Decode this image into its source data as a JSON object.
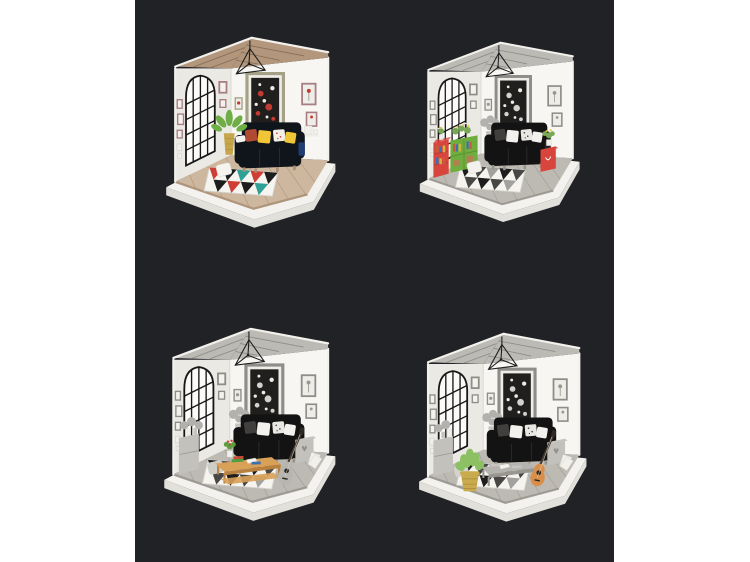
{
  "page": {
    "margin_color": "#ffffff",
    "backdrop_color": "#212226",
    "layout": "2x2 product photo collage of miniature dollhouse dioramas"
  },
  "dioramas": [
    {
      "name": "diorama-colorful-living-room",
      "alt": "Miniature dollhouse living room with dark navy sofa, yellow cushions, red and teal triangle rug, palm plant in gold pot, arched black window and tan wooden slat roof",
      "colors": {
        "roof": "#b2977d",
        "roof_slat": "#8a6f58",
        "floor": "#cdb79e",
        "floor_line": "#a98e72",
        "rug_a": "#cf3e35",
        "rug_b": "#2fa096",
        "rug_c": "#1d1d1d",
        "sofa": "#10141b",
        "sofa_trim": "#1e3d72",
        "pillow_a": "#f0c637",
        "pillow_b": "#b14a33",
        "pillow_c": "#f4efe6",
        "cushion": "#f6f4ef",
        "plant": "#6fae46",
        "pot": "#c7a64b",
        "art_frame": "#a5a186",
        "art_accent": "#c23b32",
        "wall_frame": "#a87e82"
      }
    },
    {
      "name": "diorama-gray-room-red-green-shelves",
      "alt": "Gray miniature living room with black sofa, black and white triangle rug, red bookcase, green bookshelf with plants and a red side table with yellow flowers",
      "colors": {
        "roof": "#bcbab5",
        "roof_slat": "#908e89",
        "floor": "#bdbab3",
        "floor_line": "#97948d",
        "rug_a": "#1d1d1d",
        "rug_b": "#a3a19d",
        "rug_c": "#484745",
        "sofa": "#131313",
        "sofa_trim": "#262626",
        "pillow_a": "#f3f1ed",
        "pillow_b": "#413f3d",
        "pillow_c": "#e9e7e3",
        "cushion": "#f3f1ec",
        "plant": "#7aa757",
        "flower": "#e4c43e",
        "cabinet": "#d8453c",
        "shelf": "#6fae3e",
        "side_table": "#d8453c",
        "book_a": "#c95a3a",
        "book_b": "#3e6fae",
        "book_c": "#d8b13e",
        "box": "#b08050",
        "art_frame": "#8f8d89",
        "art_accent": "#d3d1cd",
        "wall_frame": "#8f8d89"
      }
    },
    {
      "name": "diorama-gray-room-coffee-table",
      "alt": "Gray miniature living room with black sofa, tan wooden coffee table with colorful books and red flowers in a white pot, gray guitar and black and white triangle rug",
      "colors": {
        "roof": "#bcbab5",
        "roof_slat": "#908e89",
        "floor": "#bdbab3",
        "floor_line": "#97948d",
        "rug_a": "#1d1d1d",
        "rug_b": "#a3a19d",
        "rug_c": "#484745",
        "sofa": "#131313",
        "sofa_trim": "#262626",
        "pillow_a": "#f3f1ed",
        "pillow_b": "#413f3d",
        "pillow_c": "#e9e7e3",
        "cushion": "#cfcdc8",
        "plant": "#5d9e3c",
        "flower": "#cc3a30",
        "table": "#d9a058",
        "table_dark": "#b9813f",
        "guitar": "#b7b5b0",
        "book_a": "#4f9e3f",
        "book_b": "#c94a38",
        "book_c": "#3e6fae",
        "art_frame": "#8f8d89",
        "art_accent": "#d3d1cd",
        "wall_frame": "#8f8d89"
      }
    },
    {
      "name": "diorama-gray-room-basket-plant-guitar",
      "alt": "Gray miniature living room with black sofa, green potted plant in a yellow woven basket, orange acoustic guitar, gray coffee table and black and white triangle rug",
      "colors": {
        "roof": "#bcbab5",
        "roof_slat": "#908e89",
        "floor": "#bdbab3",
        "floor_line": "#97948d",
        "rug_a": "#1d1d1d",
        "rug_b": "#a3a19d",
        "rug_c": "#484745",
        "sofa": "#131313",
        "sofa_trim": "#262626",
        "pillow_a": "#f3f1ed",
        "pillow_b": "#413f3d",
        "pillow_c": "#e9e7e3",
        "cushion": "#d5d3ce",
        "plant": "#8cc063",
        "basket": "#c9ab4d",
        "basket_line": "#a8883a",
        "table": "#b5b3af",
        "table_dark": "#98968f",
        "guitar": "#d98f49",
        "art_frame": "#8f8d89",
        "art_accent": "#d3d1cd",
        "wall_frame": "#8f8d89"
      }
    }
  ]
}
